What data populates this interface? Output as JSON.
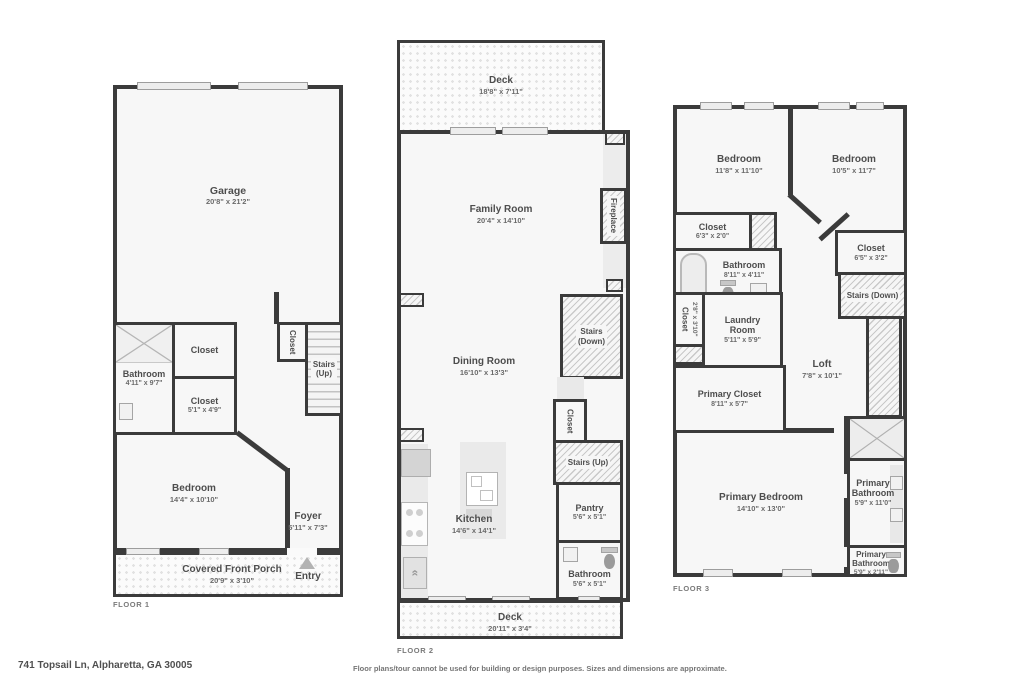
{
  "footer": {
    "address": "741 Topsail Ln, Alpharetta, GA 30005",
    "disclaimer": "Floor plans/tour cannot be used for building or design purposes. Sizes and dimensions are approximate."
  },
  "colors": {
    "wall": "#3b3b3b",
    "room_fill": "#f7f7f7",
    "hatch_line": "#c9c9c9",
    "label_text": "#4d4d4d",
    "dims_text": "#6b6b6b",
    "entry_arrow": "#b3b3b3"
  },
  "floor1": {
    "label": "FLOOR 1",
    "rooms": {
      "garage": {
        "name": "Garage",
        "dims": "20'8\" x 21'2\""
      },
      "bathroom": {
        "name": "Bathroom",
        "dims": "4'11\" x 9'7\""
      },
      "closet_top": {
        "name": "Closet"
      },
      "closet_mid": {
        "name": "Closet",
        "dims": "5'1\" x 4'9\""
      },
      "closet_stairs": {
        "name": "Closet"
      },
      "stairs": {
        "name": "Stairs",
        "dir": "(Up)"
      },
      "bedroom": {
        "name": "Bedroom",
        "dims": "14'4\" x 10'10\""
      },
      "foyer": {
        "name": "Foyer",
        "dims": "5'11\" x 7'3\""
      },
      "porch": {
        "name": "Covered Front Porch",
        "dims": "20'9\" x 3'10\""
      },
      "entry": {
        "name": "Entry"
      }
    }
  },
  "floor2": {
    "label": "FLOOR 2",
    "rooms": {
      "deck_top": {
        "name": "Deck",
        "dims": "18'8\" x 7'11\""
      },
      "family": {
        "name": "Family Room",
        "dims": "20'4\" x 14'10\""
      },
      "fireplace": {
        "name": "Fireplace"
      },
      "stairs_down": {
        "name": "Stairs",
        "dir": "(Down)"
      },
      "dining": {
        "name": "Dining Room",
        "dims": "16'10\" x 13'3\""
      },
      "closet": {
        "name": "Closet"
      },
      "stairs_up": {
        "name": "Stairs (Up)"
      },
      "kitchen": {
        "name": "Kitchen",
        "dims": "14'6\" x 14'1\""
      },
      "pantry": {
        "name": "Pantry",
        "dims": "5'6\" x 5'1\""
      },
      "bathroom": {
        "name": "Bathroom",
        "dims": "5'6\" x 5'1\""
      },
      "deck_bottom": {
        "name": "Deck",
        "dims": "20'11\" x 3'4\""
      }
    }
  },
  "floor3": {
    "label": "FLOOR 3",
    "rooms": {
      "bedroom_left": {
        "name": "Bedroom",
        "dims": "11'8\" x 11'10\""
      },
      "bedroom_right": {
        "name": "Bedroom",
        "dims": "10'5\" x 11'7\""
      },
      "closet_left": {
        "name": "Closet",
        "dims": "6'3\" x 2'0\""
      },
      "bathroom": {
        "name": "Bathroom",
        "dims": "8'11\" x 4'11\""
      },
      "closet_right": {
        "name": "Closet",
        "dims": "6'5\" x 3'2\""
      },
      "stairs_down": {
        "name": "Stairs (Down)"
      },
      "closet_vert": {
        "name": "Closet",
        "dims": "2'8\" x 3'10\""
      },
      "laundry": {
        "name": "Laundry Room",
        "dims": "5'11\" x 5'9\""
      },
      "loft": {
        "name": "Loft",
        "dims": "7'8\" x 10'1\""
      },
      "primary_closet": {
        "name": "Primary Closet",
        "dims": "8'11\" x 5'7\""
      },
      "primary_bedroom": {
        "name": "Primary Bedroom",
        "dims": "14'10\" x 13'0\""
      },
      "primary_bath_large": {
        "name": "Primary Bathroom",
        "dims": "5'9\" x 11'0\""
      },
      "primary_bath_small": {
        "name": "Primary Bathroom",
        "dims": "5'9\" x 2'11\""
      }
    }
  }
}
